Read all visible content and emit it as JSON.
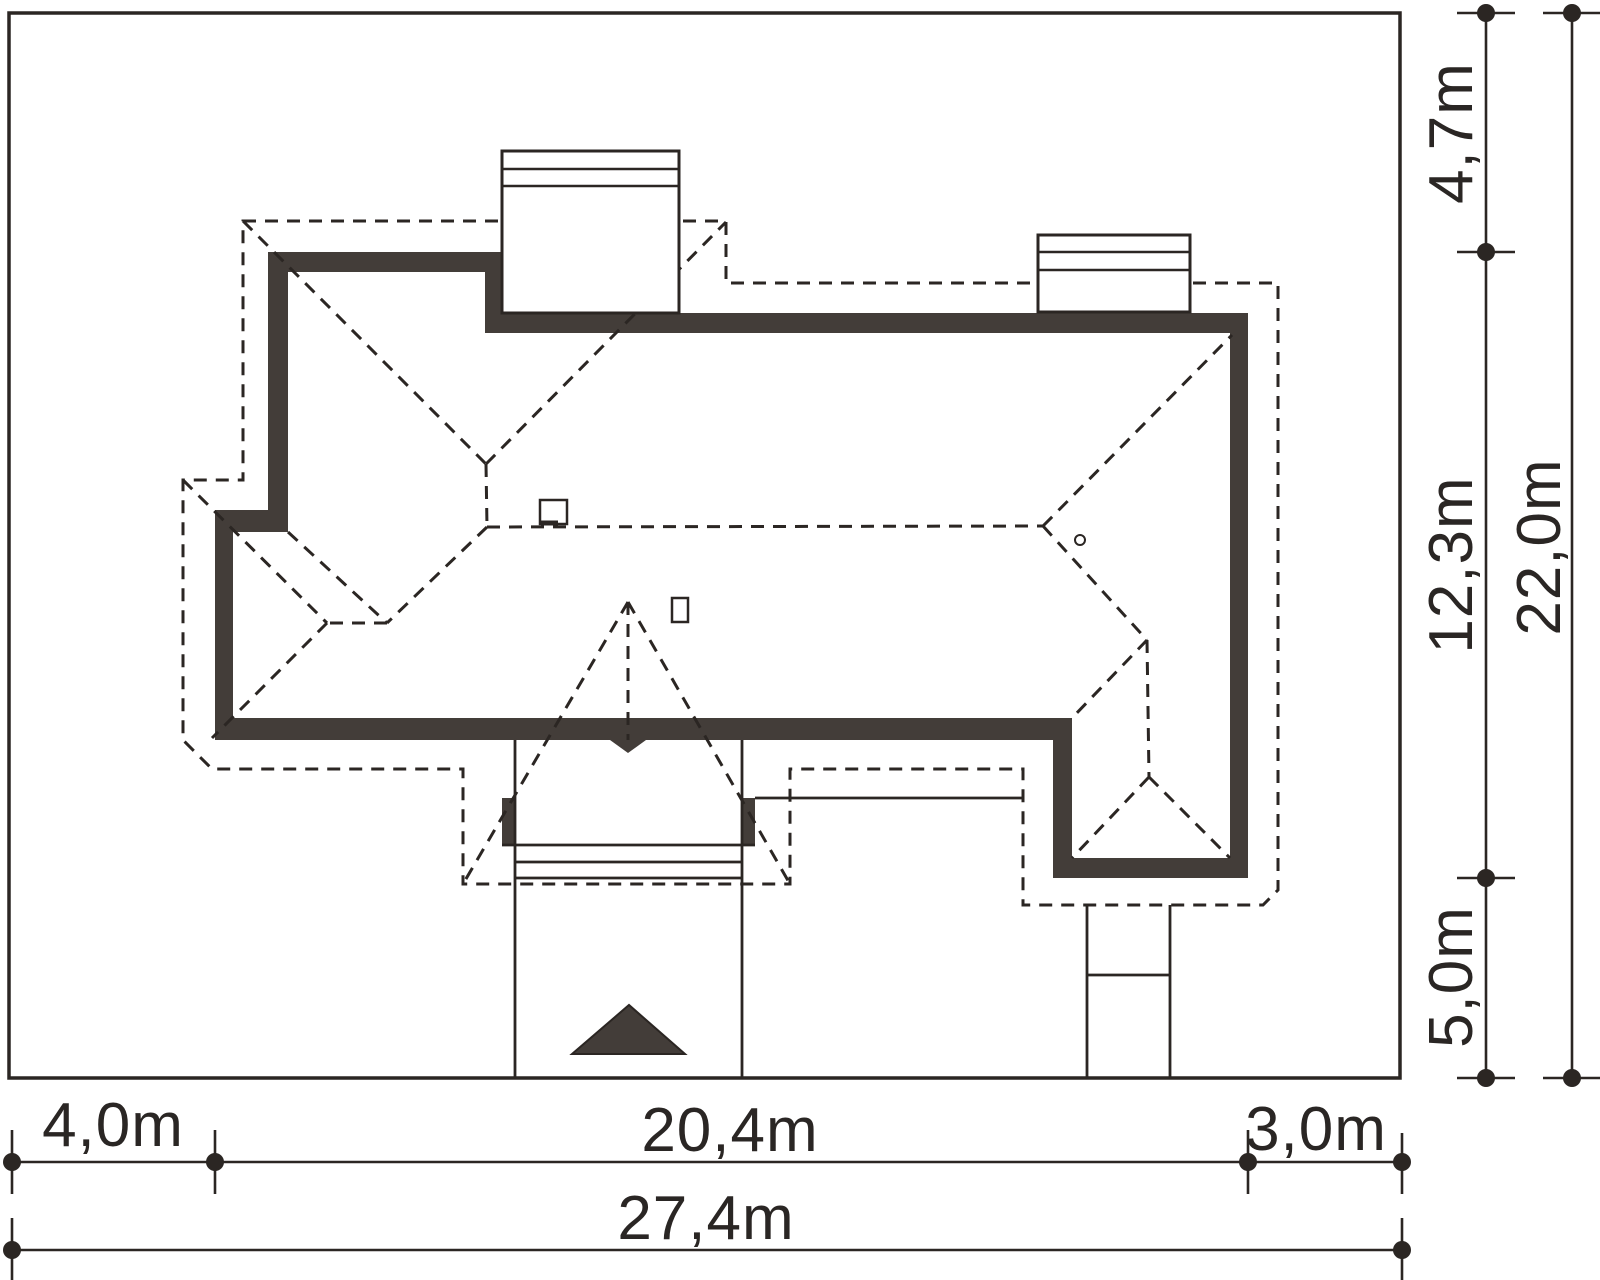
{
  "drawing": {
    "type": "house-roof-site-plan",
    "units": "m",
    "plot": {
      "width_label": "27,4m",
      "height_label": "22,0m"
    },
    "dimensions": {
      "bottom_row": [
        {
          "id": "left-setback",
          "label": "4,0m"
        },
        {
          "id": "house-width",
          "label": "20,4m"
        },
        {
          "id": "right-setback",
          "label": "3,0m"
        }
      ],
      "bottom_total": {
        "id": "plot-width",
        "label": "27,4m"
      },
      "right_column": [
        {
          "id": "top-setback",
          "label": "4,7m"
        },
        {
          "id": "house-depth",
          "label": "12,3m"
        },
        {
          "id": "bottom-setback",
          "label": "5,0m"
        }
      ],
      "right_total": {
        "id": "plot-depth",
        "label": "22,0m"
      }
    },
    "colors": {
      "line": "#2b2623",
      "wall_fill": "#433d39",
      "background": "#ffffff"
    },
    "symbols": {
      "chimney_count": 2,
      "roof_window_count": 2,
      "vent_count": 1,
      "entrance_arrow": "triangle"
    }
  }
}
